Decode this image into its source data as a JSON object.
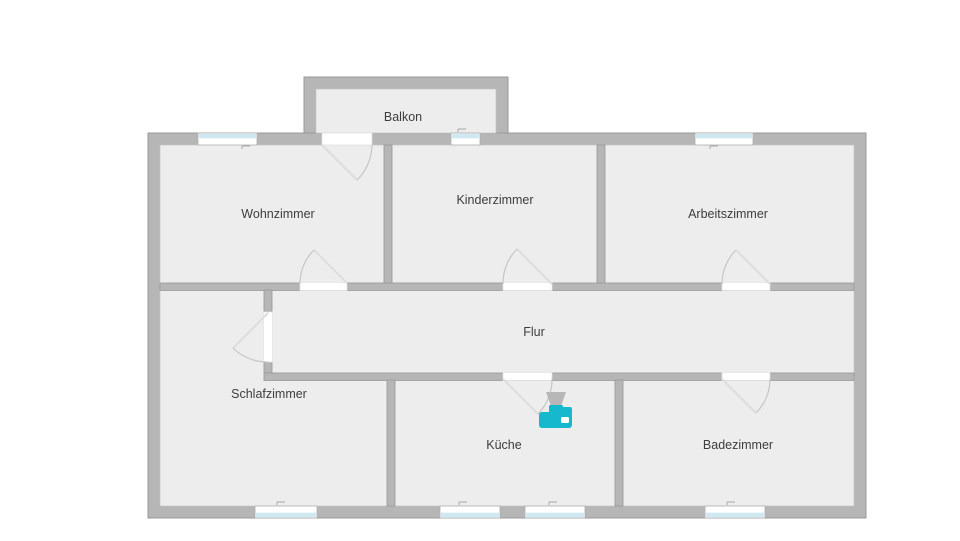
{
  "rooms": {
    "balkon": {
      "label": "Balkon"
    },
    "wohnzimmer": {
      "label": "Wohnzimmer"
    },
    "kinderzimmer": {
      "label": "Kinderzimmer"
    },
    "arbeitszimmer": {
      "label": "Arbeitszimmer"
    },
    "flur": {
      "label": "Flur"
    },
    "schlafzimmer": {
      "label": "Schlafzimmer"
    },
    "kueche": {
      "label": "Küche"
    },
    "badezimmer": {
      "label": "Badezimmer"
    }
  },
  "appliance": {
    "type": "coffee-machine",
    "room": "kueche"
  },
  "counts": {
    "rooms": 8,
    "doors": 7,
    "windows": 7
  },
  "colors": {
    "background": "#ffffff",
    "wall": "#b6b6b6",
    "wall_outline": "#9a9a9a",
    "floor": "#ededed",
    "window_glass": "#cfe8f2",
    "door_arc": "#c6c6c6",
    "appliance_teal": "#15b8cc",
    "appliance_gray": "#b7b7b7",
    "label": "#3d3d3d"
  }
}
